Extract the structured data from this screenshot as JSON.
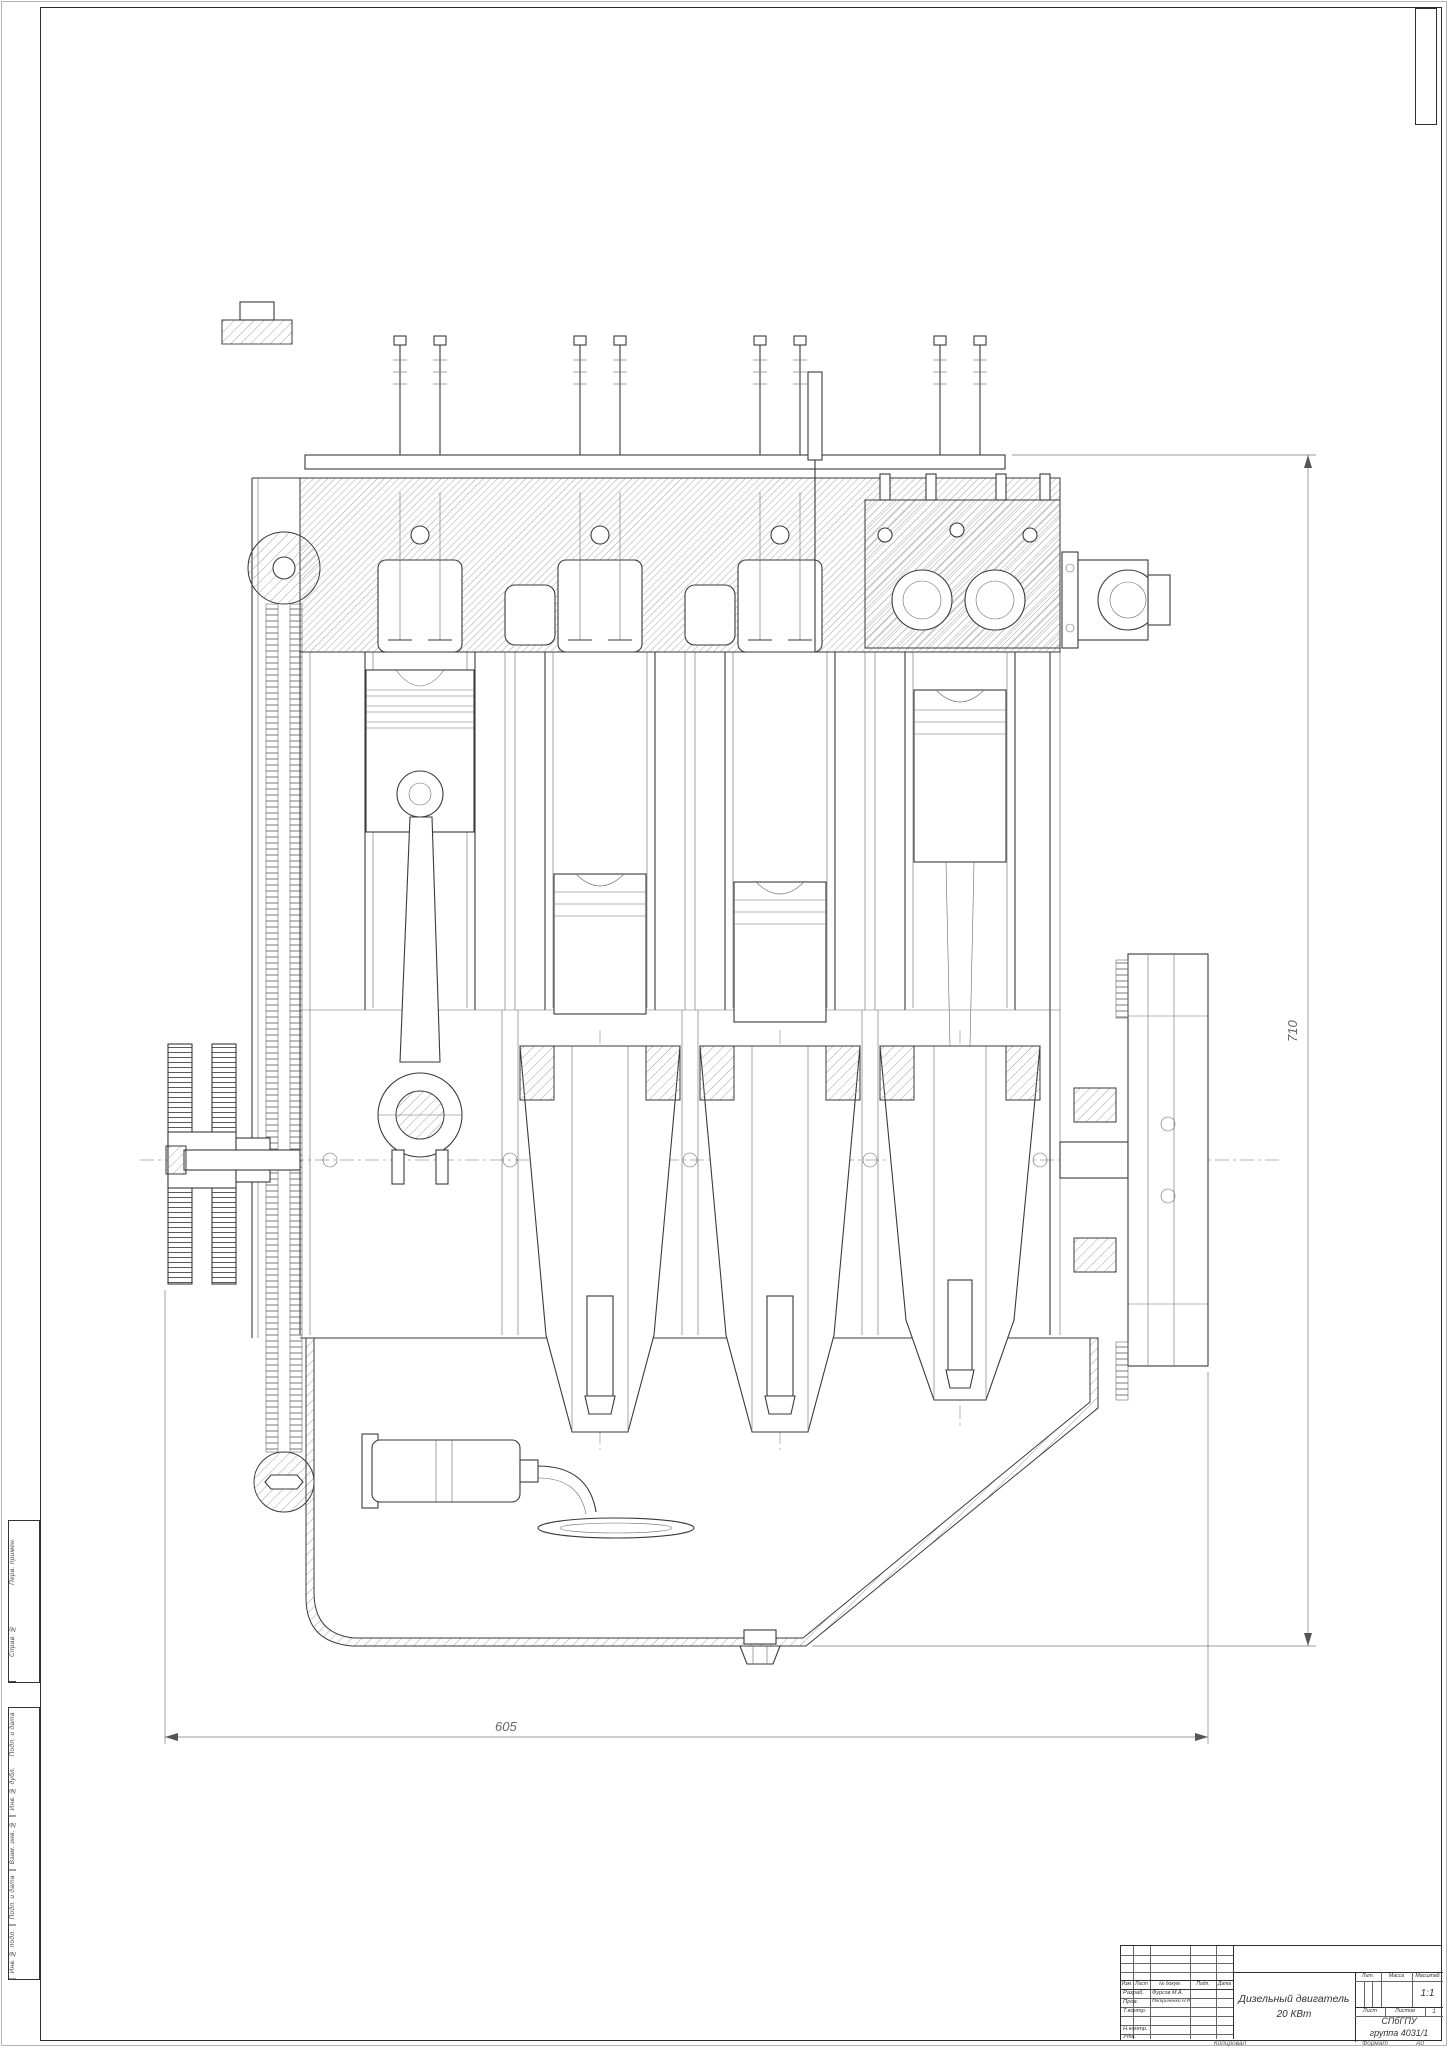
{
  "drawing_title": {
    "line1": "Дизельный двигатель",
    "line2": "20 КВт"
  },
  "dimensions": {
    "width": "605",
    "height": "710"
  },
  "frame_stamps": {
    "group1": [
      "Перв. примен.",
      "Справ. №"
    ],
    "group2": [
      "Подп. и дата",
      "Инв. № дубл.",
      "Взам. инв. №",
      "Подп. и дата",
      "Инв. № подл."
    ]
  },
  "title_block": {
    "cols": {
      "izm": "Изм.",
      "list": "Лист",
      "doc": "№ докум.",
      "podp": "Подп.",
      "data": "Дата"
    },
    "rows": [
      {
        "label": "Разраб.",
        "name": "Фурсов М.А."
      },
      {
        "label": "Пров.",
        "name": "Петриченко Н.Р."
      },
      {
        "label": "Т.контр.",
        "name": ""
      },
      {
        "label": "",
        "name": ""
      },
      {
        "label": "Н.контр.",
        "name": ""
      },
      {
        "label": "Утв.",
        "name": ""
      }
    ],
    "lit_label": "Лит.",
    "mass_label": "Масса",
    "scale_label": "Масштаб",
    "scale_value": "1:1",
    "sheet_label": "Лист",
    "sheets_label": "Листов",
    "sheets_value": "1",
    "org_line1": "СПбГПУ",
    "org_line2": "группа 4031/1"
  },
  "footer": {
    "copied": "Копировал",
    "format_label": "Формат",
    "format_value": "A0"
  }
}
